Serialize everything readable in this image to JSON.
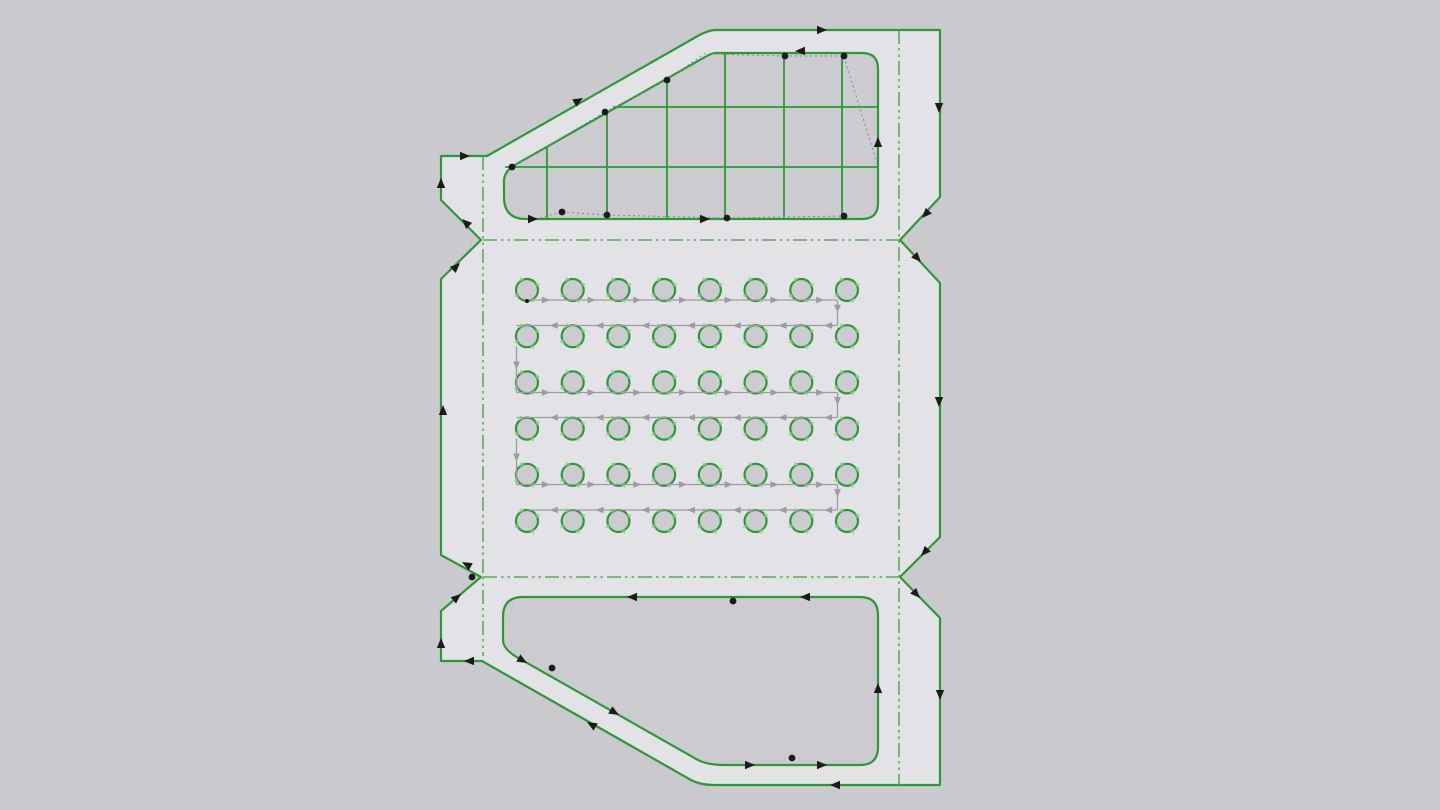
{
  "viewport": {
    "width": 1440,
    "height": 810
  },
  "colors": {
    "background": "#c9c9ce",
    "part_fill": "#e3e3e7",
    "hole_fill": "#cbcbd0",
    "contour_green": "#2f9737",
    "fold_green": "#5aaa5c",
    "toolpath_gray": "#9b9ba1",
    "rapid_gray": "#85858c",
    "marker_black": "#1b1b1b",
    "circle_arrow_green": "#94cf94"
  },
  "drawing": {
    "outer_contour": {
      "path": "M 441 156 L 487 156 L 696 37 Q 708 30 716 30 L 940 30 L 940 197 L 900 240 L 940 283 L 940 537 L 900 577 L 940 618 L 940 785 L 714 785 Q 700 785 691 780 L 482 661 L 441 661 L 441 611 L 481 577 L 441 555 L 441 279 L 481 240 L 441 200 Z"
    },
    "window_cutout": {
      "path": "M 526 219 L 862 219 Q 878 219 878 203 L 878 69 Q 878 53 862 53 L 716 53 Q 712 53 705.5 56.7 L 516 164.3 Q 504 171 504 181 L 504 197 Q 504 219 526 219 Z",
      "grid_vertical": [
        [
          547,
          146,
          219
        ],
        [
          607,
          112,
          219
        ],
        [
          667,
          79,
          219
        ],
        [
          725,
          53,
          219
        ],
        [
          784,
          53,
          219
        ],
        [
          842,
          53,
          219
        ]
      ],
      "grid_horizontal": [
        [
          613,
          878,
          107
        ],
        [
          505,
          878,
          167
        ]
      ]
    },
    "pocket_cutout": {
      "path": "M 523 597 L 860 597 Q 878 597 878 615 L 878 747 Q 878 765 860 765 L 724 765 Q 706.7 765 697 759.4 L 518 657.8 Q 503 649.3 503 640 L 503 617 Q 503 597 523 597 Z"
    },
    "holes": {
      "rows": 6,
      "cols": 8,
      "x0": 527,
      "y0": 290,
      "dx": 45.714,
      "dy": 46.2,
      "radius": 11
    },
    "fold_lines": [
      {
        "x1": 483,
        "y1": 240,
        "x2": 899,
        "y2": 240
      },
      {
        "x1": 483,
        "y1": 577,
        "x2": 899,
        "y2": 577
      }
    ],
    "bend_axis_lines": [
      {
        "x1": 483,
        "y1": 156,
        "x2": 483,
        "y2": 656
      },
      {
        "x1": 899,
        "y1": 30,
        "x2": 899,
        "y2": 785
      }
    ],
    "serpentine_segments": [
      [
        527,
        300,
        837.5,
        300
      ],
      [
        837.5,
        300,
        837.5,
        325.5
      ],
      [
        837.5,
        325.5,
        516.5,
        325.5
      ],
      [
        516.5,
        346.5,
        516.5,
        392.5
      ],
      [
        516.5,
        392.5,
        837.5,
        392.5
      ],
      [
        837.5,
        392.5,
        837.5,
        417.5
      ],
      [
        837.5,
        417.5,
        516.5,
        417.5
      ],
      [
        516.5,
        438.5,
        516.5,
        484.5
      ],
      [
        516.5,
        484.5,
        837.5,
        484.5
      ],
      [
        837.5,
        484.5,
        837.5,
        510
      ],
      [
        837.5,
        510,
        527,
        510
      ]
    ],
    "contour_arrows": [
      [
        827,
        30,
        0
      ],
      [
        939,
        113,
        90
      ],
      [
        922,
        218,
        133
      ],
      [
        921,
        262,
        47
      ],
      [
        939,
        407,
        90
      ],
      [
        921,
        556,
        133
      ],
      [
        920,
        598,
        47
      ],
      [
        940,
        700,
        90
      ],
      [
        830,
        785,
        180
      ],
      [
        587,
        722,
        -150
      ],
      [
        464,
        661,
        180
      ],
      [
        441,
        638,
        -90
      ],
      [
        461,
        594,
        -40
      ],
      [
        462,
        562,
        -151
      ],
      [
        443,
        405,
        -90
      ],
      [
        460,
        263,
        -44
      ],
      [
        462,
        219,
        -136
      ],
      [
        441,
        178,
        -90
      ],
      [
        470,
        156,
        0
      ],
      [
        583,
        98,
        -30
      ],
      [
        795,
        51,
        180
      ],
      [
        878,
        137,
        -90
      ],
      [
        538,
        219,
        0
      ],
      [
        710,
        219,
        0
      ],
      [
        627,
        597,
        180
      ],
      [
        800,
        597,
        180
      ],
      [
        878,
        683,
        -90
      ],
      [
        755,
        765,
        0
      ],
      [
        827,
        765,
        0
      ],
      [
        527,
        663,
        30
      ],
      [
        619,
        715,
        30
      ]
    ],
    "path_points": [
      [
        512,
        167
      ],
      [
        605,
        112
      ],
      [
        667,
        80
      ],
      [
        785,
        56
      ],
      [
        844,
        56
      ],
      [
        562,
        212
      ],
      [
        607,
        215
      ],
      [
        727,
        218
      ],
      [
        844,
        216
      ],
      [
        733,
        601
      ],
      [
        552,
        668
      ],
      [
        792,
        758
      ],
      [
        472,
        577
      ]
    ],
    "start_tick": [
      527,
      301
    ],
    "rapid_moves": [
      [
        512,
        167,
        605,
        112
      ],
      [
        605,
        112,
        667,
        80
      ],
      [
        667,
        80,
        708,
        51
      ],
      [
        712,
        54,
        783,
        56
      ],
      [
        785,
        56,
        842,
        56
      ],
      [
        844,
        57,
        877,
        163
      ],
      [
        540,
        218,
        561,
        212
      ],
      [
        562,
        212,
        606,
        215
      ],
      [
        608,
        215,
        726,
        218
      ],
      [
        728,
        218,
        842,
        216
      ]
    ]
  }
}
